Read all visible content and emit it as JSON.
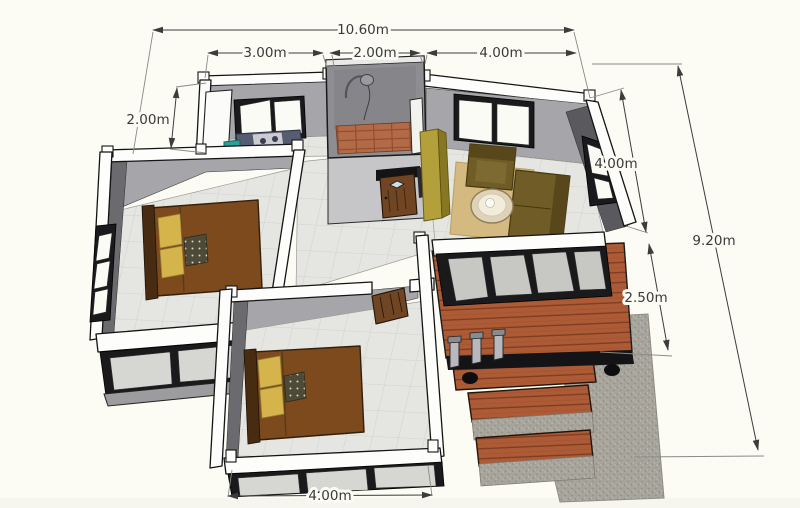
{
  "scene": {
    "type": "3d-floor-plan-perspective",
    "background_color": "#fcfcf4",
    "annotation_color": "#3a3a3a"
  },
  "dimension_labels": {
    "overall_width": "10.60m",
    "kitchen_width": "3.00m",
    "bathroom_width": "2.00m",
    "living_room_width": "4.00m",
    "kitchen_depth": "2.00m",
    "living_room_depth": "4.00m",
    "overall_depth": "9.20m",
    "terrace_depth": "2.50m",
    "bedroom_width": "4.00m"
  },
  "rooms": [
    "kitchen",
    "bathroom",
    "living-room",
    "hallway",
    "bedroom-left",
    "bedroom-bottom",
    "wooden-deck",
    "stairs",
    "concrete-path"
  ],
  "colors": {
    "wall_top": "#fdfdfc",
    "wall_face_back": "#a6a6aa",
    "wall_face_side": "#6b6b6f",
    "floor_tile": "#e5e5e2",
    "bathroom_wall": "#8e8e92",
    "bathroom_floor": "#b26a47",
    "bed": "#7c4a1d",
    "pillow": "#d6b44c",
    "sofa": "#6f5c26",
    "rug": "#d4ba80",
    "deck_wood": "#ad5b36",
    "concrete": "#a7a49c",
    "door": "#6f4523",
    "cabinet": "#b3a03b",
    "counter": "#4e5468",
    "bin": "#2aa198",
    "window_frame": "#1a1a1d"
  }
}
